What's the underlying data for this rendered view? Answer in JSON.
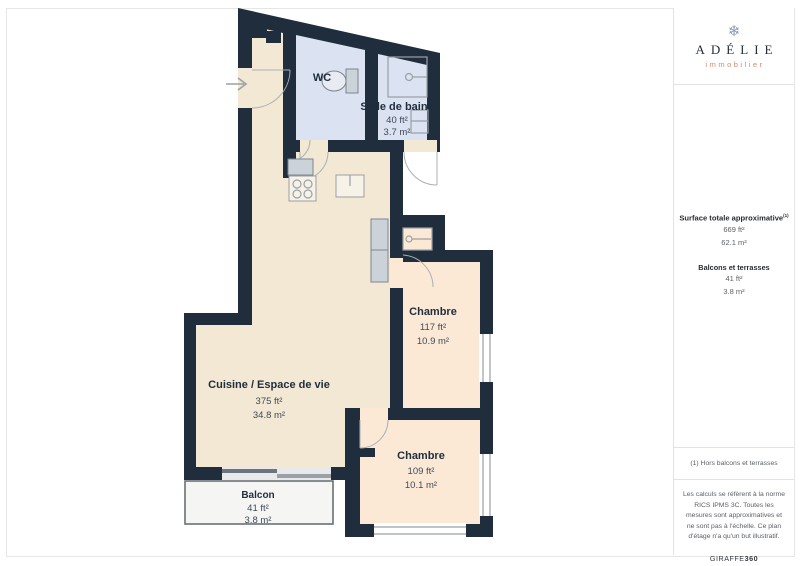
{
  "plan": {
    "colors": {
      "wall": "#1f2d3d",
      "floor_living": "#f2e8d3",
      "floor_bedroom": "#fbe9d6",
      "floor_wet": "#dbe2f1",
      "balcony_fill": "#f5f5f4"
    },
    "rooms": [
      {
        "id": "wc",
        "name": "WC",
        "area_ft": "",
        "area_m": ""
      },
      {
        "id": "bathroom",
        "name": "Salle de bains",
        "area_ft": "40 ft²",
        "area_m": "3.7 m²"
      },
      {
        "id": "bedroom-1",
        "name": "Chambre",
        "area_ft": "117 ft²",
        "area_m": "10.9 m²"
      },
      {
        "id": "living",
        "name": "Cuisine / Espace de vie",
        "area_ft": "375 ft²",
        "area_m": "34.8 m²"
      },
      {
        "id": "bedroom-2",
        "name": "Chambre",
        "area_ft": "109 ft²",
        "area_m": "10.1 m²"
      },
      {
        "id": "balcony",
        "name": "Balcon",
        "area_ft": "41 ft²",
        "area_m": "3.8 m²"
      }
    ],
    "icons": [
      "entrance-arrow-icon",
      "toilet-icon",
      "shower-icon",
      "sink-icon",
      "stove-icon",
      "wardrobe",
      "closet-icon"
    ]
  },
  "sidebar": {
    "logo": {
      "icon": "snowflake-icon",
      "glyph": "❄",
      "brand": "ADÉLIE",
      "tagline": "immobilier"
    },
    "surface": {
      "title": "Surface totale approximative",
      "title_sup": "(1)",
      "total_ft": "669 ft²",
      "total_m": "62.1 m²",
      "balcony_title": "Balcons et terrasses",
      "balcony_ft": "41 ft²",
      "balcony_m": "3.8 m²"
    },
    "footnote": "(1) Hors balcons et terrasses",
    "disclaimer": "Les calculs se réfèrent à la norme RICS IPMS 3C. Toutes les mesures sont approximatives et ne sont pas à l'échelle. Ce plan d'étage n'a qu'un but illustratif.",
    "credit_brand": "GIRAFFE",
    "credit_num": "360"
  }
}
